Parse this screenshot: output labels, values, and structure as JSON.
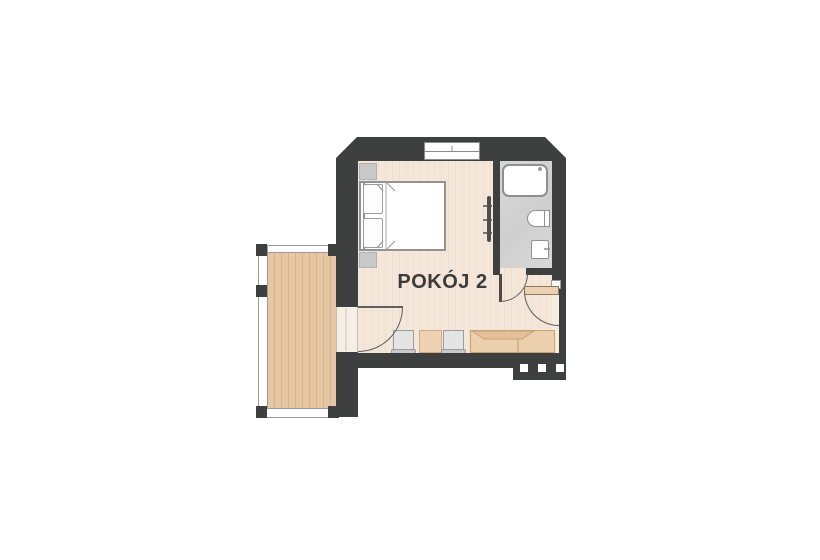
{
  "plan": {
    "room_label": "POKÓJ 2"
  },
  "colors": {
    "wall": "#3e4040",
    "room_floor": "#f3e5d7",
    "balcony_wood": "#e2c09c",
    "bathroom_floor": "#d4d4d4",
    "furniture_tan": "#eccfad",
    "fixture_outline": "#8f8f8f",
    "label_text": "#3b3b3b"
  },
  "features": {
    "rooms": [
      "main-room",
      "bathroom",
      "balcony"
    ],
    "furniture": [
      "double-bed",
      "nightstand",
      "nightstand",
      "chair",
      "chair",
      "side-table",
      "desk"
    ],
    "fixtures": [
      "shower",
      "toilet",
      "sink",
      "radiator"
    ],
    "openings": [
      "window",
      "balcony-door",
      "bathroom-door",
      "entrance-door"
    ],
    "other": [
      "balcony-railing",
      "entry-steps"
    ]
  }
}
